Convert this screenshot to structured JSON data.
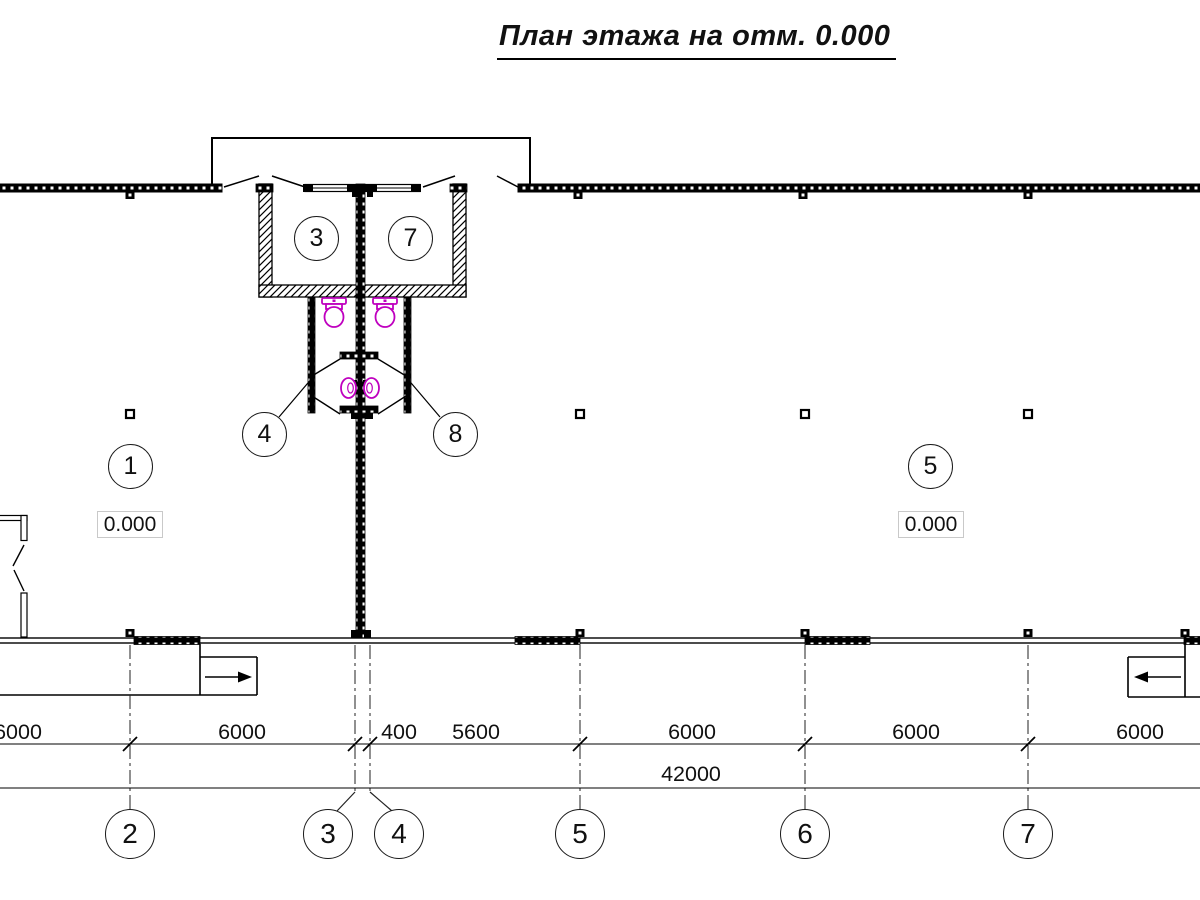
{
  "title": "План этажа на отм. 0.000",
  "rooms": [
    {
      "number": "1"
    },
    {
      "number": "3"
    },
    {
      "number": "7"
    },
    {
      "number": "4"
    },
    {
      "number": "8"
    },
    {
      "number": "5"
    }
  ],
  "elevations": [
    {
      "value": "0.000"
    },
    {
      "value": "0.000"
    }
  ],
  "dimensions": {
    "row1": [
      "6000",
      "6000",
      "400",
      "5600",
      "6000",
      "6000",
      "6000"
    ],
    "total": "42000"
  },
  "axes": [
    "2",
    "3",
    "4",
    "5",
    "6",
    "7"
  ],
  "colors": {
    "line": "#000000",
    "fixture_magenta": "#bf00bf",
    "window_gray": "#808080"
  }
}
